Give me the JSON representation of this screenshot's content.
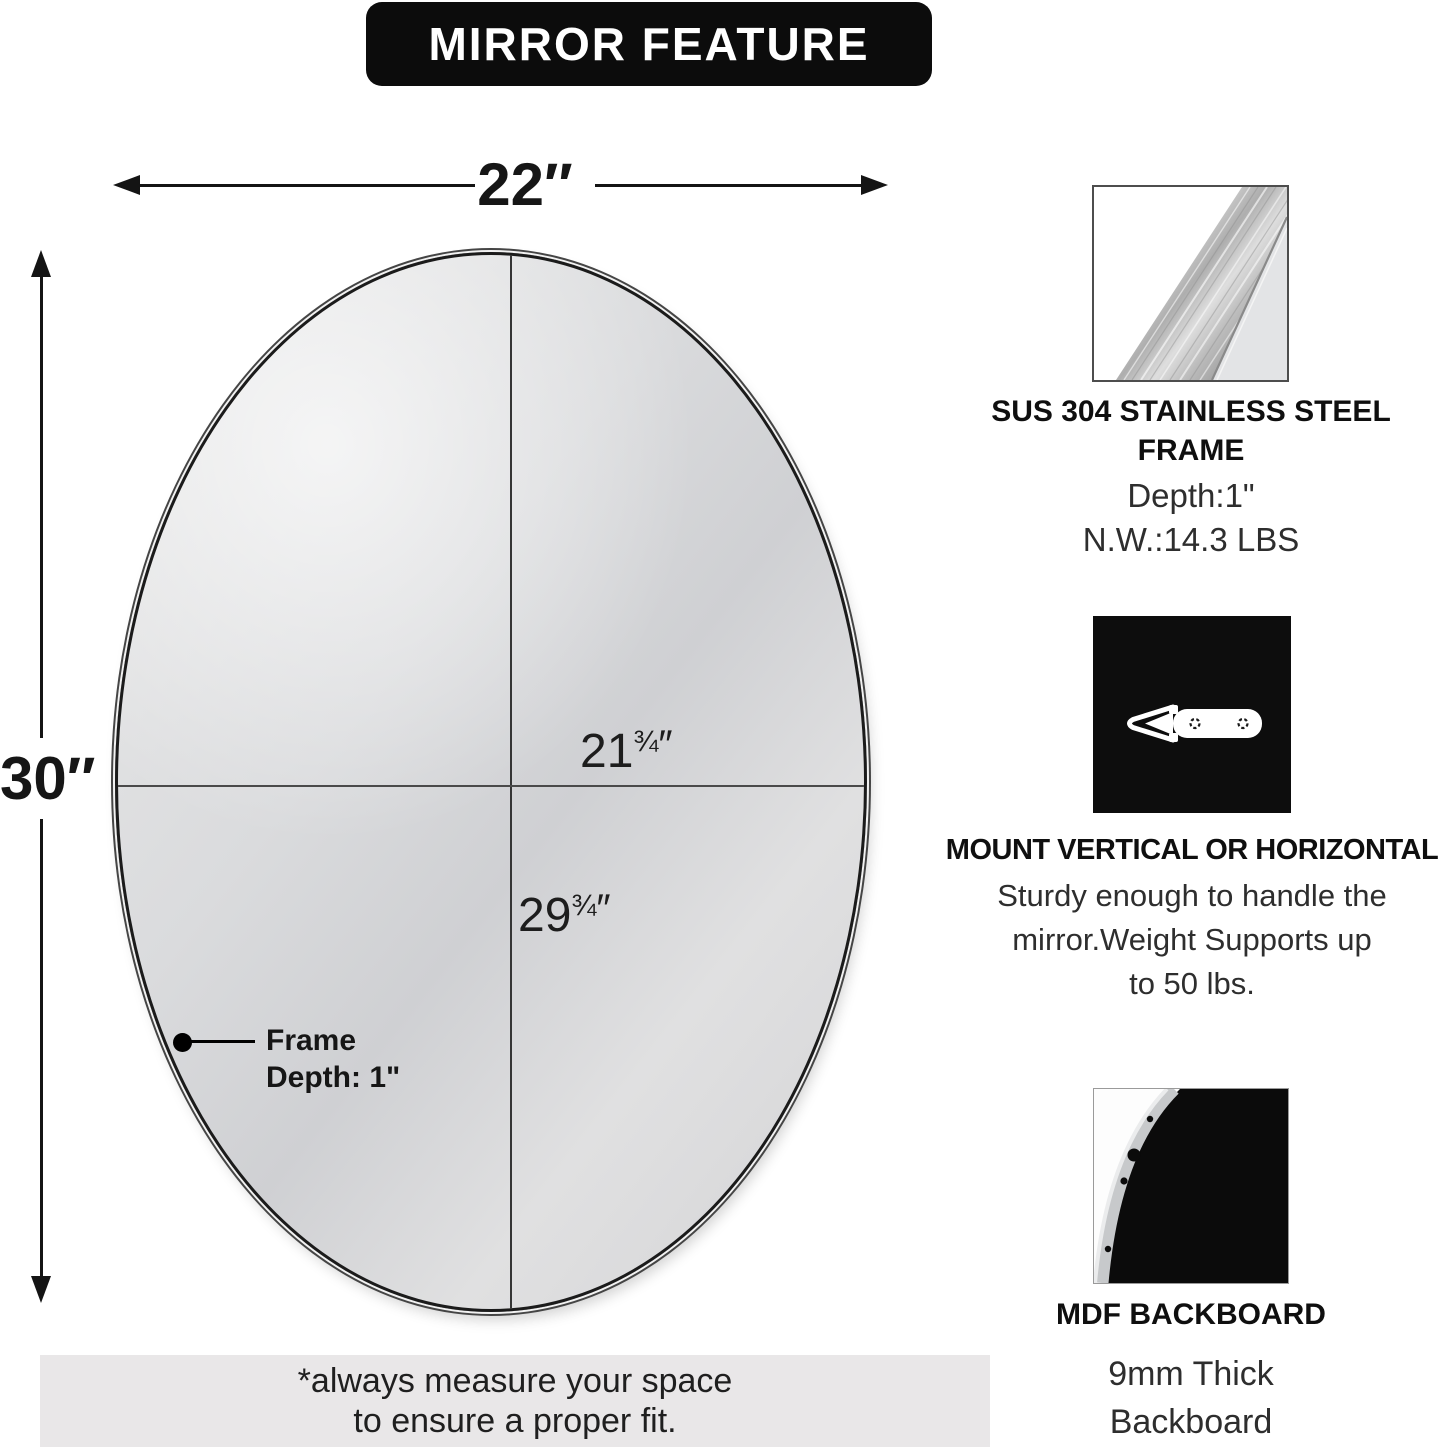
{
  "title": "MIRROR FEATURE",
  "diagram": {
    "outer_width_label": "22″",
    "outer_height_label": "30″",
    "inner_width": {
      "whole": "21",
      "fraction": "¾",
      "unit": "″"
    },
    "inner_height": {
      "whole": "29",
      "fraction": "¾",
      "unit": "″"
    },
    "frame_callout": {
      "line1": "Frame",
      "line2": "Depth: 1\""
    }
  },
  "features": [
    {
      "icon": "brushed-stainless-steel-swatch",
      "title": "SUS 304 STAINLESS STEEL FRAME",
      "body_lines": [
        "Depth:1\"",
        "N.W.:14.3 LBS"
      ]
    },
    {
      "icon": "wall-mount-bracket",
      "title": "MOUNT VERTICAL OR HORIZONTAL",
      "body_lines": [
        "Sturdy enough to handle the",
        "mirror.Weight Supports up",
        "to 50 lbs."
      ]
    },
    {
      "icon": "mdf-backboard-corner",
      "title": "MDF BACKBOARD",
      "body_lines": [
        "9mm Thick",
        "Backboard"
      ]
    }
  ],
  "note_lines": [
    "*always measure your space",
    "to ensure a proper fit."
  ],
  "colors": {
    "banner_bg": "#0c0c0c",
    "banner_text": "#ffffff",
    "note_bg": "#e9e7e8",
    "frame": "#1b1b1b",
    "dimension_line": "#141414"
  }
}
